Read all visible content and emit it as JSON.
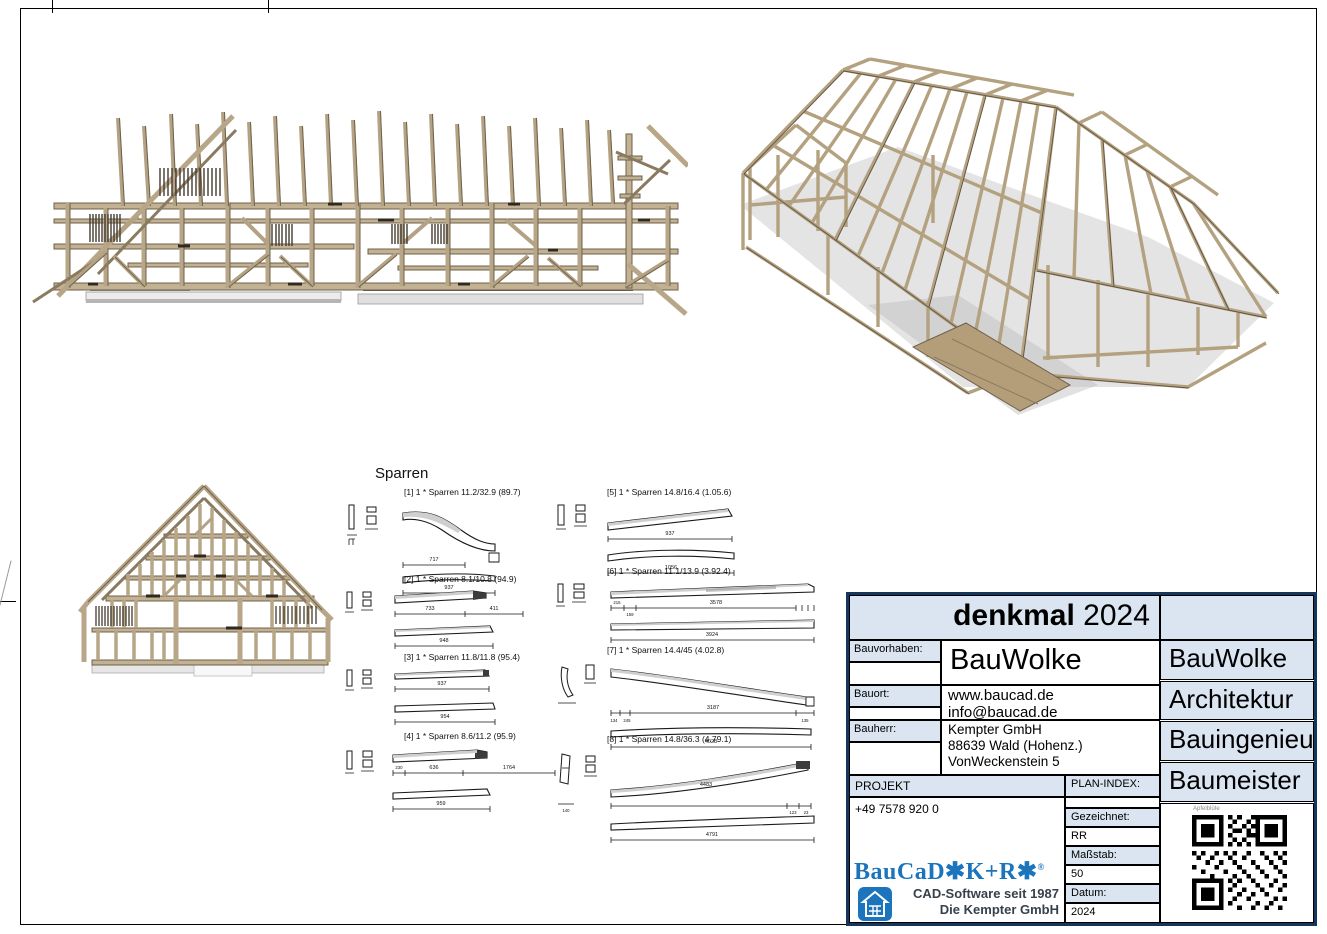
{
  "colors": {
    "navy": "#17365d",
    "light_blue": "#dbe5f1",
    "logo_blue": "#1b74bc",
    "wood": "#b7a687",
    "wood_dark": "#6f604a",
    "shadow_gray": "#c9c9c9"
  },
  "sparren": {
    "title": "Sparren",
    "items": [
      {
        "label": "[1] 1 * Sparren 11.2/32.9 (89.7)",
        "dims": [
          "717",
          "937"
        ]
      },
      {
        "label": "[2] 1 * Sparren 8.1/10.8 (94.9)",
        "dims": [
          "733",
          "411",
          "948"
        ]
      },
      {
        "label": "[3] 1 * Sparren 11.8/11.8 (95.4)",
        "dims": [
          "937",
          "954"
        ]
      },
      {
        "label": "[4] 1 * Sparren 8.6/11.2 (95.9)",
        "dims": [
          "230",
          "636",
          "1764",
          "959"
        ]
      },
      {
        "label": "[5] 1 * Sparren 14.8/16.4 (1.05.6)",
        "dims": [
          "937",
          "1056"
        ]
      },
      {
        "label": "[6] 1 * Sparren 11.1/13.9 (3.92.4)",
        "dims": [
          "215",
          "159",
          "3578",
          "3924"
        ]
      },
      {
        "label": "[7] 1 * Sparren 14.4/45 (4.02.8)",
        "dims": [
          "134",
          "245",
          "3187",
          "135",
          "4028"
        ]
      },
      {
        "label": "[8] 1 * Sparren 14.8/36.3 (4.79.1)",
        "dims": [
          "140",
          "4483",
          "123",
          "23",
          "4791"
        ]
      }
    ]
  },
  "title_block": {
    "title_bold": "denkmal",
    "title_year": "2024",
    "fields": [
      {
        "label": "Bauvorhaben:",
        "lines": [
          "BauWolke"
        ]
      },
      {
        "label": "Bauort:",
        "lines": [
          "www.baucad.de",
          "info@baucad.de"
        ]
      },
      {
        "label": "Bauherr:",
        "lines": [
          "Kempter GmbH",
          "88639 Wald (Hohenz.)",
          "VonWeckenstein 5"
        ]
      }
    ],
    "right_column": [
      "BauWolke",
      "Architektur",
      "Bauingenieur",
      "Baumeister"
    ],
    "projekt_label": "PROJEKT",
    "phone": "+49 7578 920 0",
    "plan_index_label": "PLAN-INDEX:",
    "meta": [
      {
        "label": "Gezeichnet:",
        "value": "RR"
      },
      {
        "label": "Maßstab:",
        "value": "50"
      },
      {
        "label": "Datum:",
        "value": "2024"
      }
    ],
    "logo": {
      "brand": "BauCaD",
      "brand_suffix": "✱K+R✱",
      "registered": "®",
      "line1": "CAD-Software seit 1987",
      "line2": "Die Kempter GmbH"
    },
    "qr_caption": "Apfelblüte"
  }
}
